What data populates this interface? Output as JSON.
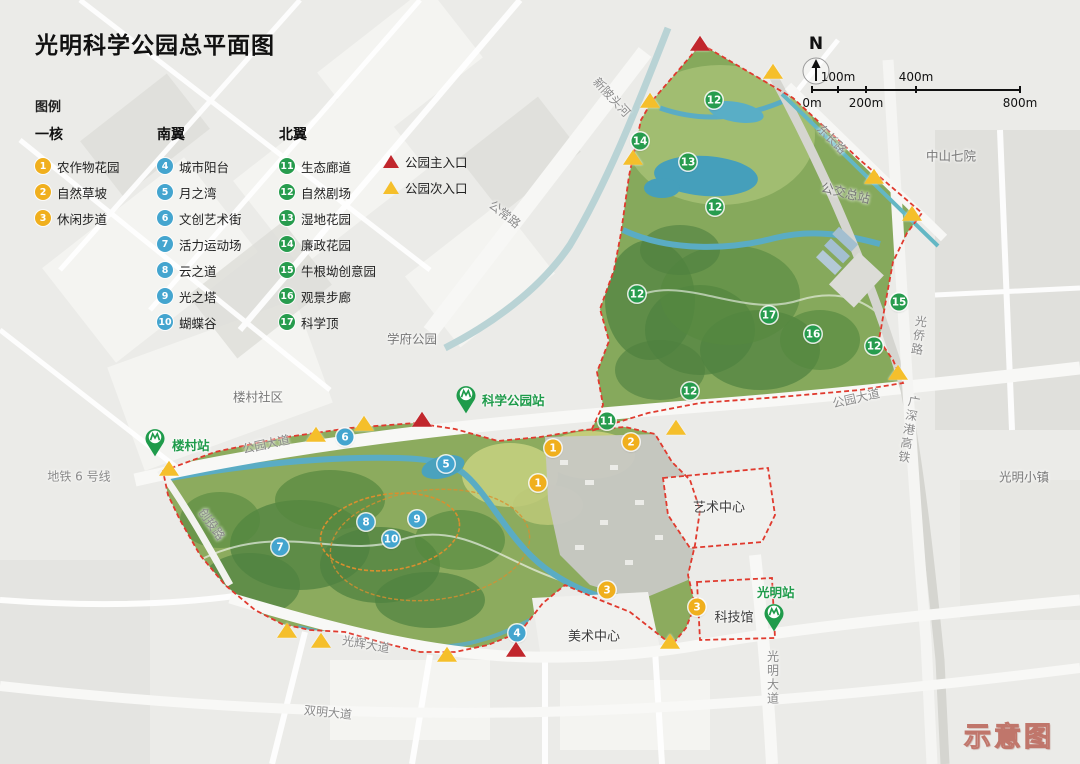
{
  "title": "光明科学公园总平面图",
  "watermark": "示意图",
  "compass": {
    "label": "N"
  },
  "scalebar": {
    "ticks": [
      {
        "label": "0m",
        "pos": 12,
        "row": "bottom"
      },
      {
        "label": "100m",
        "pos": 38,
        "row": "top"
      },
      {
        "label": "200m",
        "pos": 66,
        "row": "bottom"
      },
      {
        "label": "400m",
        "pos": 116,
        "row": "top"
      },
      {
        "label": "800m",
        "pos": 220,
        "row": "bottom"
      }
    ]
  },
  "legend": {
    "heading": "图例",
    "groups": [
      {
        "id": "core",
        "name": "一核",
        "color": "#F0AF1D",
        "items": [
          {
            "num": "1",
            "label": "农作物花园"
          },
          {
            "num": "2",
            "label": "自然草坡"
          },
          {
            "num": "3",
            "label": "休闲步道"
          }
        ]
      },
      {
        "id": "south",
        "name": "南翼",
        "color": "#44A5CF",
        "items": [
          {
            "num": "4",
            "label": "城市阳台"
          },
          {
            "num": "5",
            "label": "月之湾"
          },
          {
            "num": "6",
            "label": "文创艺术街"
          },
          {
            "num": "7",
            "label": "活力运动场"
          },
          {
            "num": "8",
            "label": "云之道"
          },
          {
            "num": "9",
            "label": "光之塔"
          },
          {
            "num": "10",
            "label": "蝴蝶谷"
          }
        ]
      },
      {
        "id": "north",
        "name": "北翼",
        "color": "#279C4E",
        "items": [
          {
            "num": "11",
            "label": "生态廊道"
          },
          {
            "num": "12",
            "label": "自然剧场"
          },
          {
            "num": "13",
            "label": "湿地花园"
          },
          {
            "num": "14",
            "label": "廉政花园"
          },
          {
            "num": "15",
            "label": "牛根坳创意园"
          },
          {
            "num": "16",
            "label": "观景步廊"
          },
          {
            "num": "17",
            "label": "科学顶"
          }
        ]
      }
    ],
    "entrances": [
      {
        "type": "main",
        "label": "公园主入口",
        "color": "#C1272D"
      },
      {
        "type": "secondary",
        "label": "公园次入口",
        "color": "#F5BF2B"
      }
    ]
  },
  "map": {
    "markers": [
      {
        "num": "12",
        "x": 714,
        "y": 100,
        "g": "north"
      },
      {
        "num": "14",
        "x": 640,
        "y": 141,
        "g": "north"
      },
      {
        "num": "13",
        "x": 688,
        "y": 162,
        "g": "north"
      },
      {
        "num": "12",
        "x": 715,
        "y": 207,
        "g": "north"
      },
      {
        "num": "12",
        "x": 637,
        "y": 294,
        "g": "north"
      },
      {
        "num": "17",
        "x": 769,
        "y": 315,
        "g": "north"
      },
      {
        "num": "16",
        "x": 813,
        "y": 334,
        "g": "north"
      },
      {
        "num": "15",
        "x": 899,
        "y": 302,
        "g": "north"
      },
      {
        "num": "12",
        "x": 874,
        "y": 346,
        "g": "north"
      },
      {
        "num": "12",
        "x": 690,
        "y": 391,
        "g": "north"
      },
      {
        "num": "11",
        "x": 607,
        "y": 421,
        "g": "north"
      },
      {
        "num": "6",
        "x": 345,
        "y": 437,
        "g": "south"
      },
      {
        "num": "5",
        "x": 446,
        "y": 464,
        "g": "south"
      },
      {
        "num": "7",
        "x": 280,
        "y": 547,
        "g": "south"
      },
      {
        "num": "8",
        "x": 366,
        "y": 522,
        "g": "south"
      },
      {
        "num": "9",
        "x": 417,
        "y": 519,
        "g": "south"
      },
      {
        "num": "10",
        "x": 391,
        "y": 539,
        "g": "south"
      },
      {
        "num": "4",
        "x": 517,
        "y": 633,
        "g": "south"
      },
      {
        "num": "1",
        "x": 553,
        "y": 448,
        "g": "core"
      },
      {
        "num": "2",
        "x": 631,
        "y": 442,
        "g": "core"
      },
      {
        "num": "1",
        "x": 538,
        "y": 483,
        "g": "core"
      },
      {
        "num": "3",
        "x": 607,
        "y": 590,
        "g": "core"
      },
      {
        "num": "3",
        "x": 697,
        "y": 607,
        "g": "core"
      }
    ],
    "entrances": [
      {
        "x": 700,
        "y": 44,
        "t": "main"
      },
      {
        "x": 422,
        "y": 420,
        "t": "main"
      },
      {
        "x": 516,
        "y": 650,
        "t": "main"
      },
      {
        "x": 773,
        "y": 72,
        "t": "sec"
      },
      {
        "x": 650,
        "y": 101,
        "t": "sec"
      },
      {
        "x": 633,
        "y": 158,
        "t": "sec"
      },
      {
        "x": 874,
        "y": 177,
        "t": "sec"
      },
      {
        "x": 912,
        "y": 214,
        "t": "sec"
      },
      {
        "x": 898,
        "y": 373,
        "t": "sec"
      },
      {
        "x": 316,
        "y": 435,
        "t": "sec"
      },
      {
        "x": 364,
        "y": 424,
        "t": "sec"
      },
      {
        "x": 169,
        "y": 469,
        "t": "sec"
      },
      {
        "x": 676,
        "y": 428,
        "t": "sec"
      },
      {
        "x": 670,
        "y": 642,
        "t": "sec"
      },
      {
        "x": 287,
        "y": 631,
        "t": "sec"
      },
      {
        "x": 321,
        "y": 641,
        "t": "sec"
      },
      {
        "x": 447,
        "y": 655,
        "t": "sec"
      }
    ],
    "labels": [
      {
        "text": "新陂头河",
        "x": 612,
        "y": 97,
        "rot": 47,
        "cls": "road"
      },
      {
        "text": "公常路",
        "x": 505,
        "y": 214,
        "rot": 38,
        "cls": "road"
      },
      {
        "text": "东长路",
        "x": 832,
        "y": 139,
        "rot": 45,
        "cls": "road"
      },
      {
        "text": "中山七院",
        "x": 951,
        "y": 155,
        "rot": 0,
        "cls": "place"
      },
      {
        "text": "公交总站",
        "x": 846,
        "y": 192,
        "rot": 14,
        "cls": "place"
      },
      {
        "text": "光侨路",
        "x": 919,
        "y": 336,
        "rot": 8,
        "cls": "road",
        "vert": true
      },
      {
        "text": "公园大道",
        "x": 856,
        "y": 398,
        "rot": -13,
        "cls": "road"
      },
      {
        "text": "广深港高铁",
        "x": 909,
        "y": 430,
        "rot": 10,
        "cls": "road",
        "vert": true
      },
      {
        "text": "光明小镇",
        "x": 1024,
        "y": 476,
        "rot": 0,
        "cls": "place"
      },
      {
        "text": "学府公园",
        "x": 412,
        "y": 338,
        "rot": 0,
        "cls": "place"
      },
      {
        "text": "楼村社区",
        "x": 258,
        "y": 396,
        "rot": 0,
        "cls": "place"
      },
      {
        "text": "公园大道",
        "x": 266,
        "y": 444,
        "rot": -12,
        "cls": "road"
      },
      {
        "text": "地铁 6 号线",
        "x": 79,
        "y": 476,
        "rot": 0,
        "cls": "road"
      },
      {
        "text": "创投路",
        "x": 212,
        "y": 524,
        "rot": 55,
        "cls": "road"
      },
      {
        "text": "光辉大道",
        "x": 366,
        "y": 644,
        "rot": 10,
        "cls": "road"
      },
      {
        "text": "双明大道",
        "x": 328,
        "y": 712,
        "rot": 6,
        "cls": "road"
      },
      {
        "text": "光明大道",
        "x": 773,
        "y": 678,
        "rot": 0,
        "cls": "road",
        "vert": true
      },
      {
        "text": "美术中心",
        "x": 594,
        "y": 635,
        "rot": 0,
        "cls": "facility"
      },
      {
        "text": "艺术中心",
        "x": 719,
        "y": 506,
        "rot": 0,
        "cls": "facility"
      },
      {
        "text": "科技馆",
        "x": 734,
        "y": 616,
        "rot": 0,
        "cls": "facility"
      }
    ],
    "stations": [
      {
        "label": "楼村站",
        "px": 155,
        "py": 447,
        "lx": 172,
        "ly": 443
      },
      {
        "label": "科学公园站",
        "px": 466,
        "py": 404,
        "lx": 482,
        "ly": 398
      },
      {
        "label": "光明站",
        "px": 774,
        "py": 622,
        "lx": 757,
        "ly": 590
      }
    ],
    "station_color": "#1f9b4b"
  }
}
